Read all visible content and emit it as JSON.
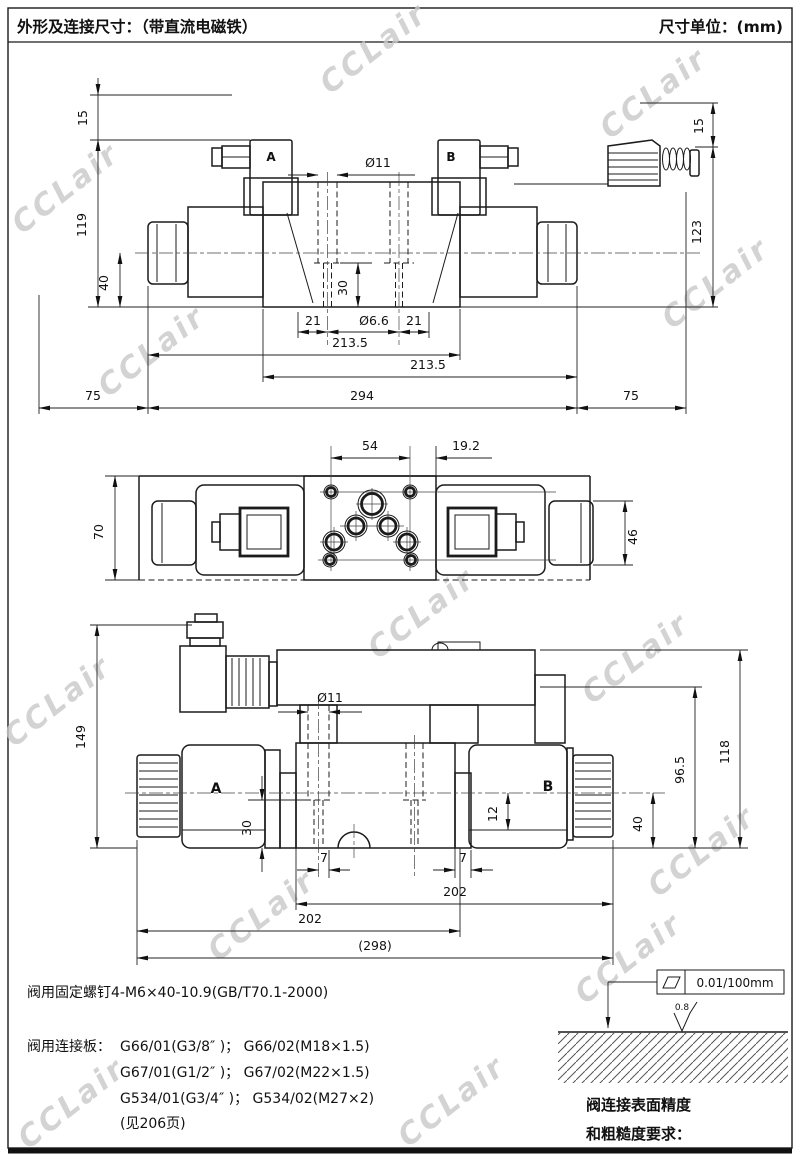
{
  "header": {
    "left": "外形及连接尺寸：（带直流电磁铁）",
    "right": "尺寸单位：(mm)"
  },
  "watermark": {
    "text": "CCLair"
  },
  "front_view": {
    "port_a": "A",
    "port_b": "B",
    "dims": {
      "plug_gap_left": "15",
      "height_left": "119",
      "center_to_base": "40",
      "plug_gap_right": "15",
      "height_right": "123",
      "counterbore_dia": "Ø11",
      "counterbore_depth": "30",
      "edge_left": "21",
      "bolt_hole_dia": "Ø6.6",
      "edge_right": "21",
      "span_left": "213.5",
      "span_right": "213.5",
      "body_length": "294",
      "removal_left": "75",
      "removal_right": "75"
    }
  },
  "top_view": {
    "dims": {
      "hole_spacing": "54",
      "edge_offset": "19.2",
      "body_width": "70",
      "cap_dia": "46"
    }
  },
  "side_view": {
    "port_a": "A",
    "port_b": "B",
    "dims": {
      "overall_height": "149",
      "counterbore_dia": "Ø11",
      "counterbore_depth": "30",
      "offset_left": "7",
      "offset_right": "7",
      "center_offset": "12",
      "center_to_base": "40",
      "tube_height": "96.5",
      "top_height": "118",
      "span_left": "202",
      "span_right": "202",
      "overall_length": "(298)"
    }
  },
  "notes": {
    "fixing_screw": "阀用固定螺钉4-M6×40-10.9(GB/T70.1-2000)",
    "subplate_label": "阀用连接板：",
    "subplate_line1": "G66/01(G3/8″ )；  G66/02(M18×1.5)",
    "subplate_line2": "G67/01(G1/2″ )；  G67/02(M22×1.5)",
    "subplate_line3": "G534/01(G3/4″ )；  G534/02(M27×2)",
    "subplate_line4": "(见206页)"
  },
  "surface_req": {
    "flatness": "0.01/100mm",
    "roughness": "0.8",
    "caption_line1": "阀连接表面精度",
    "caption_line2": "和粗糙度要求："
  }
}
